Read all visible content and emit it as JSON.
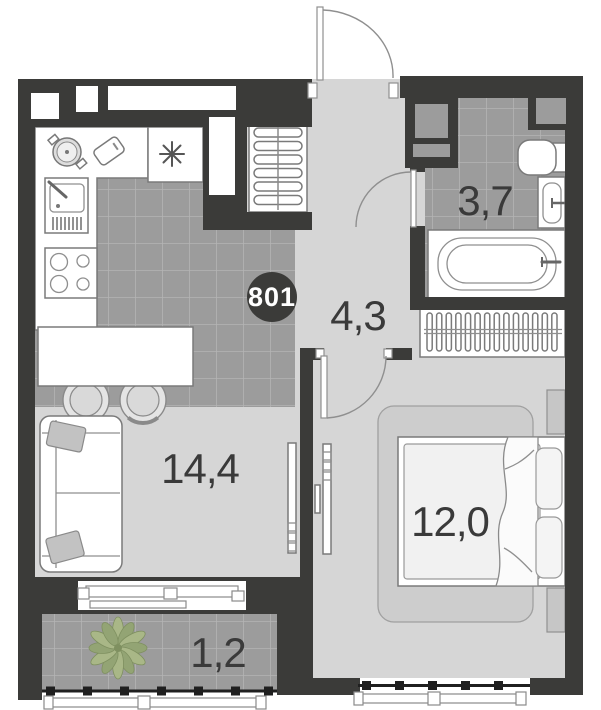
{
  "plan": {
    "apartment_number": "801",
    "rooms": [
      {
        "id": "kitchen-living-room",
        "area": "14,4"
      },
      {
        "id": "hall",
        "area": "4,3"
      },
      {
        "id": "bathroom",
        "area": "3,7"
      },
      {
        "id": "bedroom",
        "area": "12,0"
      },
      {
        "id": "balcony",
        "area": "1,2"
      }
    ],
    "colors": {
      "wall": "#3b3b39",
      "floor_tile": "#9c9c9c",
      "tile_grid_line": "#b4b4b4",
      "floor_light": "#d6d6d6",
      "furniture_outline": "#7a7a7a",
      "label_text": "#3a3a3a",
      "badge_background": "#3b3b39",
      "badge_text": "#ffffff",
      "plant_leaf": "#a9b787",
      "railing": "#1f1f1f"
    }
  }
}
